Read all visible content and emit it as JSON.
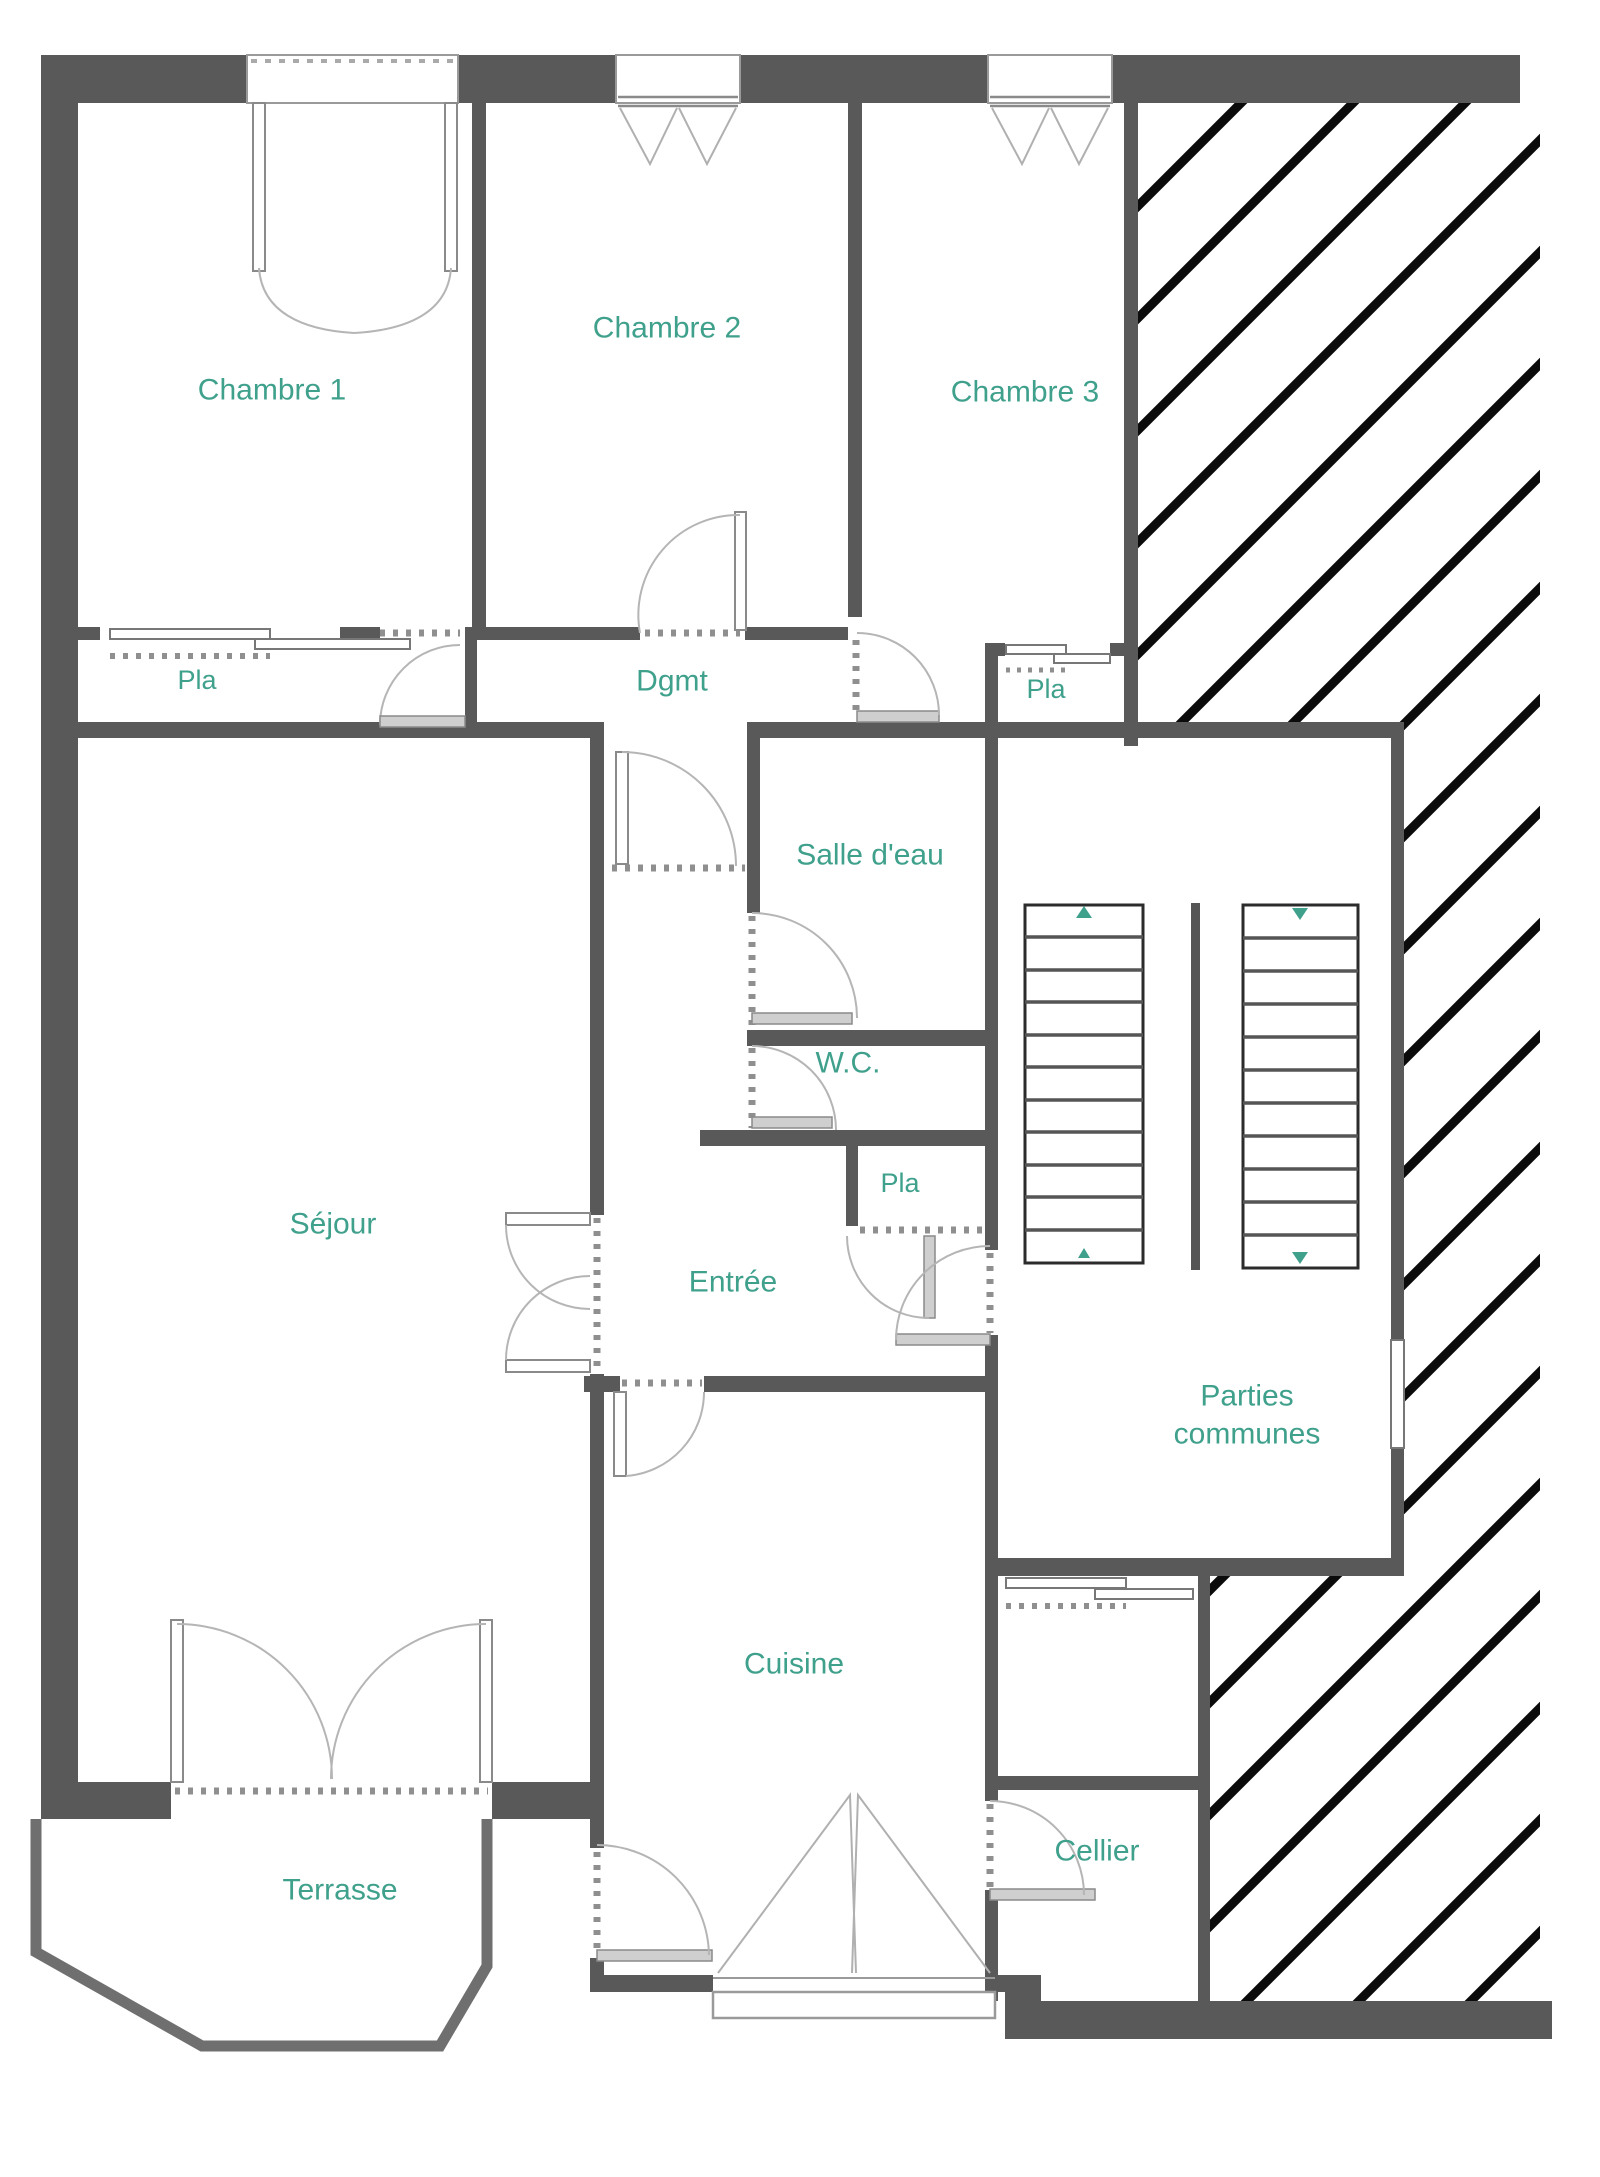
{
  "plan": {
    "title": "Plan d'appartement - étage",
    "language": "fr",
    "type": "floor-plan"
  },
  "colors": {
    "wall": "#595959",
    "terrace_wall": "#6f6f6f",
    "label": "#3fa08c",
    "door_arc": "#b5b5b5",
    "door_leaf": "#cfcfcf",
    "hatch": "#0b0b0b",
    "stair_tread": "#555555",
    "background": "#ffffff"
  },
  "rooms": [
    {
      "id": "chambre-1",
      "label": "Chambre 1",
      "x": 272,
      "y": 390,
      "size": 30
    },
    {
      "id": "chambre-2",
      "label": "Chambre 2",
      "x": 667,
      "y": 328,
      "size": 30
    },
    {
      "id": "chambre-3",
      "label": "Chambre 3",
      "x": 1025,
      "y": 392,
      "size": 30
    },
    {
      "id": "pla-chambre-1",
      "label": "Pla",
      "x": 197,
      "y": 681,
      "size": 27
    },
    {
      "id": "dgmt",
      "label": "Dgmt",
      "x": 672,
      "y": 681,
      "size": 30
    },
    {
      "id": "pla-chambre-3",
      "label": "Pla",
      "x": 1046,
      "y": 690,
      "size": 27
    },
    {
      "id": "salle-d-eau",
      "label": "Salle d'eau",
      "x": 870,
      "y": 855,
      "size": 30
    },
    {
      "id": "wc",
      "label": "W.C.",
      "x": 848,
      "y": 1063,
      "size": 30
    },
    {
      "id": "pla-entree",
      "label": "Pla",
      "x": 900,
      "y": 1184,
      "size": 27
    },
    {
      "id": "sejour",
      "label": "Séjour",
      "x": 333,
      "y": 1224,
      "size": 30
    },
    {
      "id": "entree",
      "label": "Entrée",
      "x": 733,
      "y": 1282,
      "size": 30
    },
    {
      "id": "parties-communes",
      "label": "Parties\ncommunes",
      "x": 1247,
      "y": 1415,
      "size": 30
    },
    {
      "id": "cuisine",
      "label": "Cuisine",
      "x": 794,
      "y": 1664,
      "size": 30
    },
    {
      "id": "cellier",
      "label": "Cellier",
      "x": 1097,
      "y": 1851,
      "size": 30
    },
    {
      "id": "terrasse",
      "label": "Terrasse",
      "x": 340,
      "y": 1890,
      "size": 30
    }
  ],
  "stairs": {
    "location": "parties-communes",
    "flights": [
      {
        "id": "left",
        "treads": 11,
        "direction": "up"
      },
      {
        "id": "right",
        "treads": 11,
        "direction": "down"
      }
    ],
    "arrow_color": "#3fa08c"
  },
  "features": {
    "windows": [
      "chambre-1",
      "chambre-2",
      "chambre-3",
      "cuisine"
    ],
    "sliding_closets": [
      "pla-chambre-1",
      "pla-chambre-3",
      "rangement-parties-communes"
    ],
    "hinged_doors": [
      "chambre-1",
      "chambre-2",
      "chambre-3",
      "salle-d-eau",
      "wc",
      "pla-entree",
      "entree-palier",
      "sejour-entree-double",
      "entree-cuisine",
      "cuisine-service",
      "cellier",
      "sejour-terrasse-double",
      "palier"
    ],
    "hatched_zones": 3
  }
}
